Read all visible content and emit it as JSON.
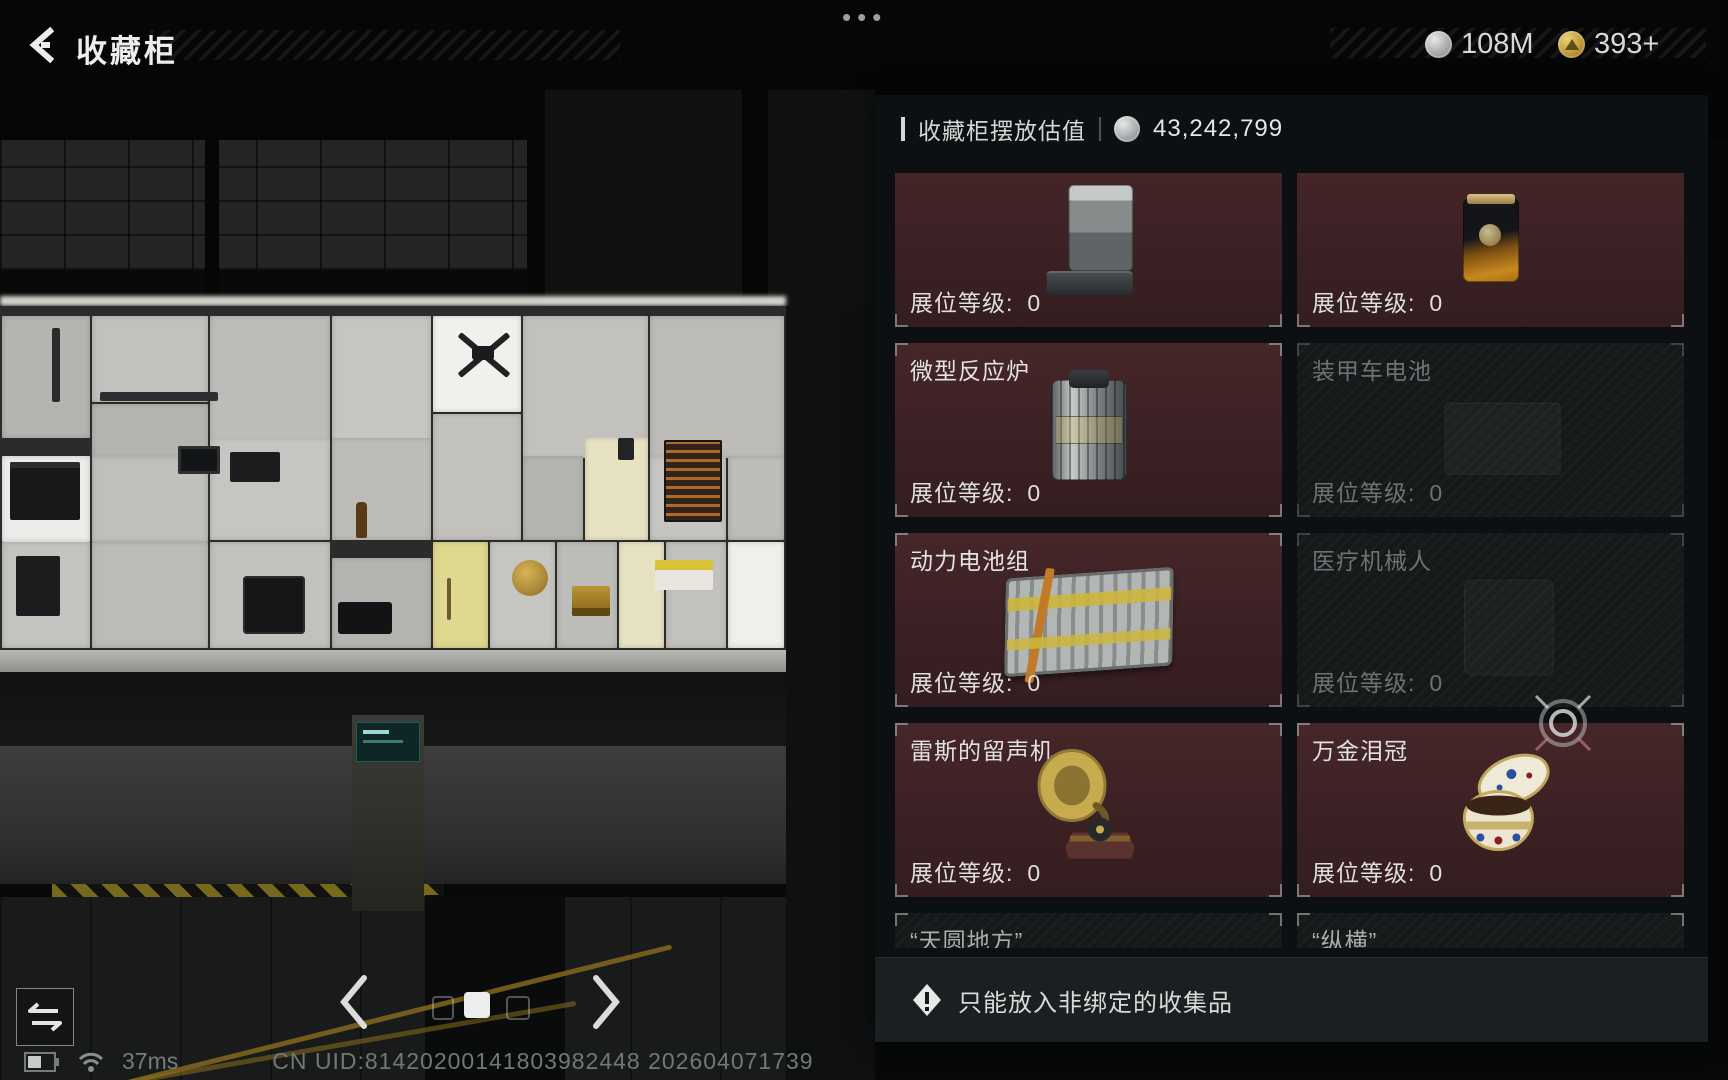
{
  "header": {
    "title": "收藏柜",
    "menu_dots": "•••",
    "currency_silver": "108M",
    "currency_gold": "393+"
  },
  "panel": {
    "value_label": "收藏柜摆放估值",
    "value": "43,242,799",
    "level_label": "展位等级:",
    "tiles": [
      {
        "name": "",
        "level": "0",
        "item": "robot-vacuum",
        "state": "placed"
      },
      {
        "name": "",
        "level": "0",
        "item": "coffee-bag",
        "state": "placed"
      },
      {
        "name": "微型反应炉",
        "level": "0",
        "item": "micro-reactor",
        "state": "placed"
      },
      {
        "name": "装甲车电池",
        "level": "0",
        "item": "armored-vehicle-battery",
        "state": "empty"
      },
      {
        "name": "动力电池组",
        "level": "0",
        "item": "power-battery-pack",
        "state": "placed"
      },
      {
        "name": "医疗机械人",
        "level": "0",
        "item": "medical-robot",
        "state": "empty"
      },
      {
        "name": "雷斯的留声机",
        "level": "0",
        "item": "gramophone",
        "state": "placed"
      },
      {
        "name": "万金泪冠",
        "level": "0",
        "item": "tear-crown",
        "state": "placed"
      },
      {
        "name": "“天圆地方”",
        "level": "0",
        "item": "",
        "state": "partial"
      },
      {
        "name": "“纵横”",
        "level": "0",
        "item": "",
        "state": "partial"
      }
    ],
    "notice": "只能放入非绑定的收集品"
  },
  "footer": {
    "ping": "37ms",
    "uid": "CN UID:81420200141803982448 202604071739"
  }
}
